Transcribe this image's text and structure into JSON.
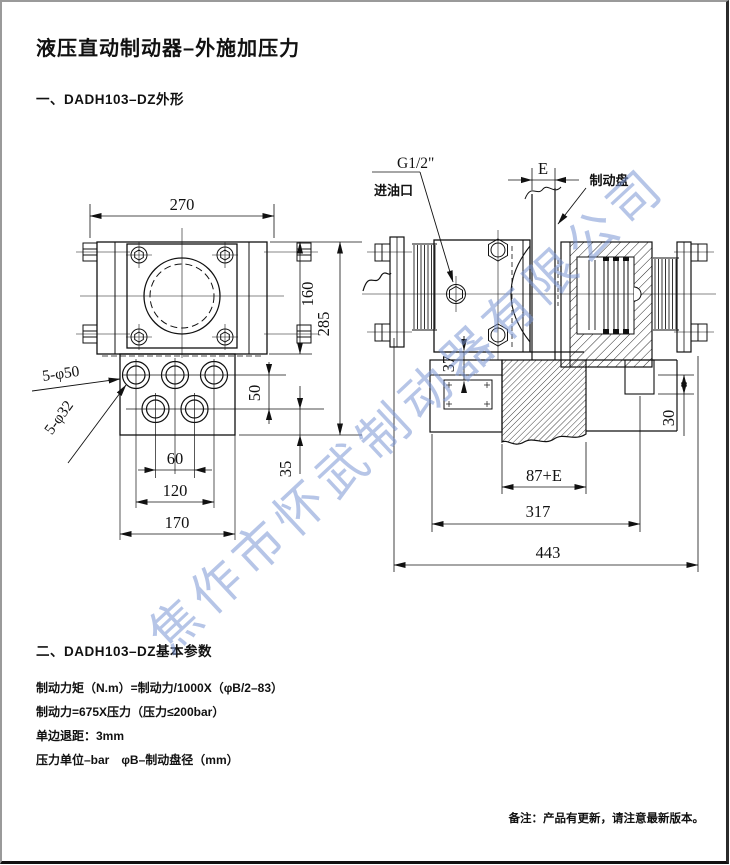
{
  "page": {
    "title": "液压直动制动器–外施加压力",
    "section1": "一、DADH103–DZ外形",
    "section2": "二、DADH103–DZ基本参数",
    "params": [
      "制动力矩（N.m）=制动力/1000X（φB/2–83）",
      "制动力=675X压力（压力≤200bar）",
      "单边退距：3mm",
      "压力单位–bar　φB–制动盘径（mm）"
    ],
    "footer_note": "备注：产品有更新，请注意最新版本。",
    "watermark": "焦作市怀武制动器有限公司"
  },
  "front_view": {
    "dims": {
      "w270": "270",
      "h160": "160",
      "h285": "285",
      "gap50": "50",
      "off35": "35",
      "s60": "60",
      "s120": "120",
      "s170": "170"
    },
    "labels": {
      "holes50": "5-φ50",
      "holes32": "5-φ32"
    }
  },
  "side_view": {
    "dims": {
      "e": "E",
      "d37": "37",
      "d30": "30",
      "w87e": "87+E",
      "w317": "317",
      "w443": "443"
    },
    "labels": {
      "thread": "G1/2\"",
      "port": "进油口",
      "disc": "制动盘"
    }
  }
}
